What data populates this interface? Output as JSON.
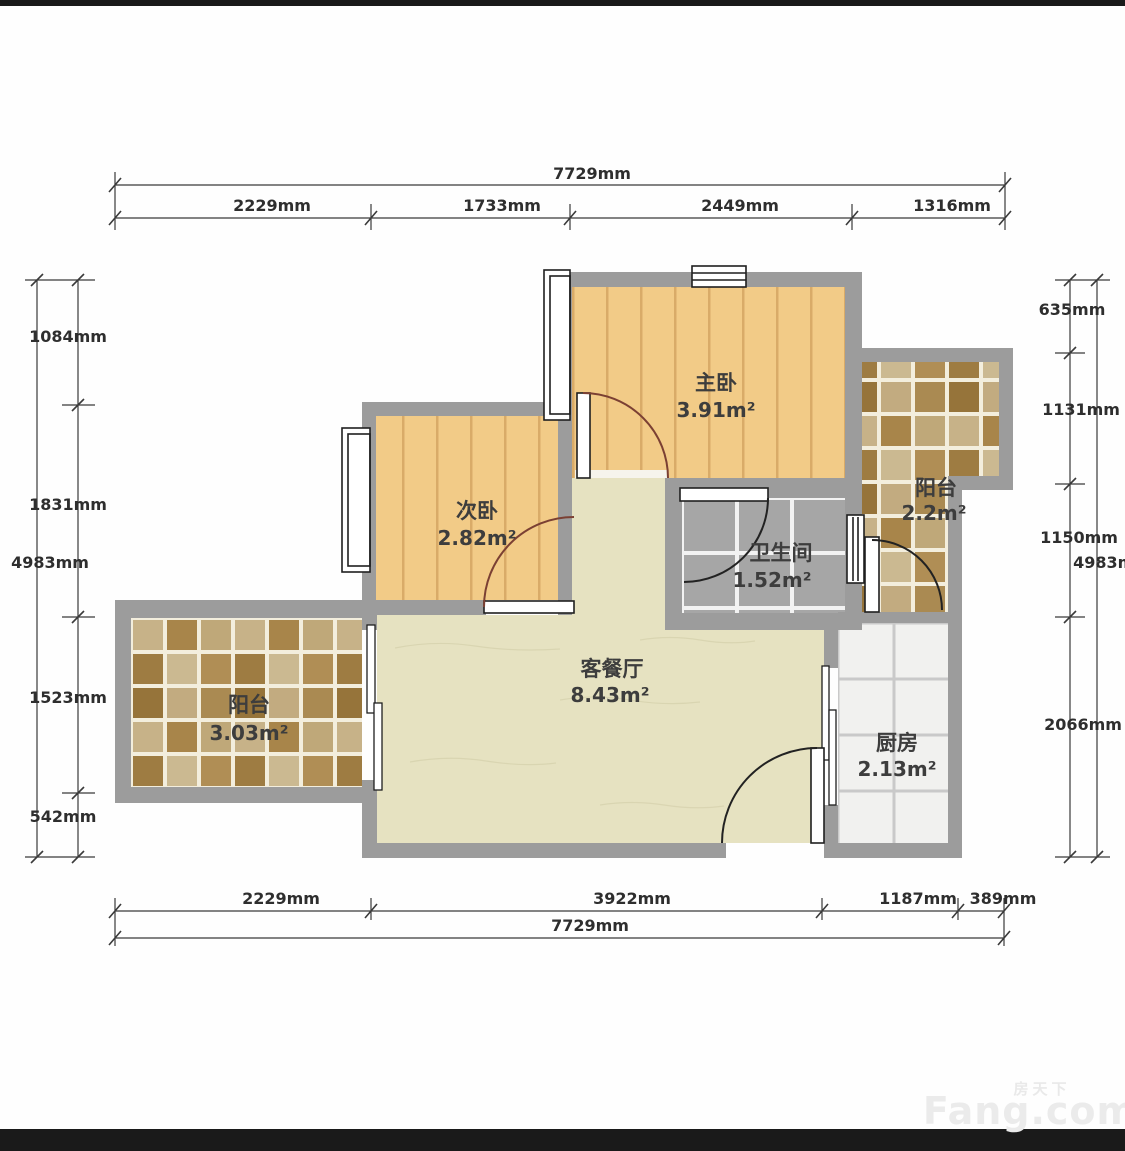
{
  "floorplan": {
    "rooms": {
      "master_bedroom": {
        "name": "主卧",
        "area": "3.91m²"
      },
      "second_bedroom": {
        "name": "次卧",
        "area": "2.82m²"
      },
      "bathroom": {
        "name": "卫生间",
        "area": "1.52m²"
      },
      "living_dining": {
        "name": "客餐厅",
        "area": "8.43m²"
      },
      "kitchen": {
        "name": "厨房",
        "area": "2.13m²"
      },
      "balcony_left": {
        "name": "阳台",
        "area": "3.03m²"
      },
      "balcony_right": {
        "name": "阳台",
        "area": "2.2m²"
      }
    },
    "dimensions": {
      "top": {
        "total": "7729mm",
        "segments": [
          "2229mm",
          "1733mm",
          "2449mm",
          "1316mm"
        ]
      },
      "bottom": {
        "total": "7729mm",
        "segments": [
          "2229mm",
          "3922mm",
          "1187mm",
          "389mm"
        ]
      },
      "left": {
        "total": "4983mm",
        "segments": [
          "1084mm",
          "1831mm",
          "1523mm",
          "542mm"
        ]
      },
      "right": {
        "total": "4983mm",
        "segments": [
          "635mm",
          "1131mm",
          "1150mm",
          "2066mm"
        ]
      }
    },
    "watermark": {
      "brand_cn": "房天下",
      "brand_en": "Fang.com"
    },
    "colors": {
      "wall_gray": "#9c9c9c",
      "wood_floor": "#f2cb87",
      "wood_stripe": "#d9ab68",
      "living_floor": "#e6e2c1",
      "bath_tile": "#a6a6a6",
      "kitchen_tile": "#f1f1ef",
      "door_arc_bedroom": "#7b4033",
      "door_arc_dark": "#222222",
      "dim_line": "#3a3a3a",
      "bar_black": "#1a1a1a"
    }
  }
}
